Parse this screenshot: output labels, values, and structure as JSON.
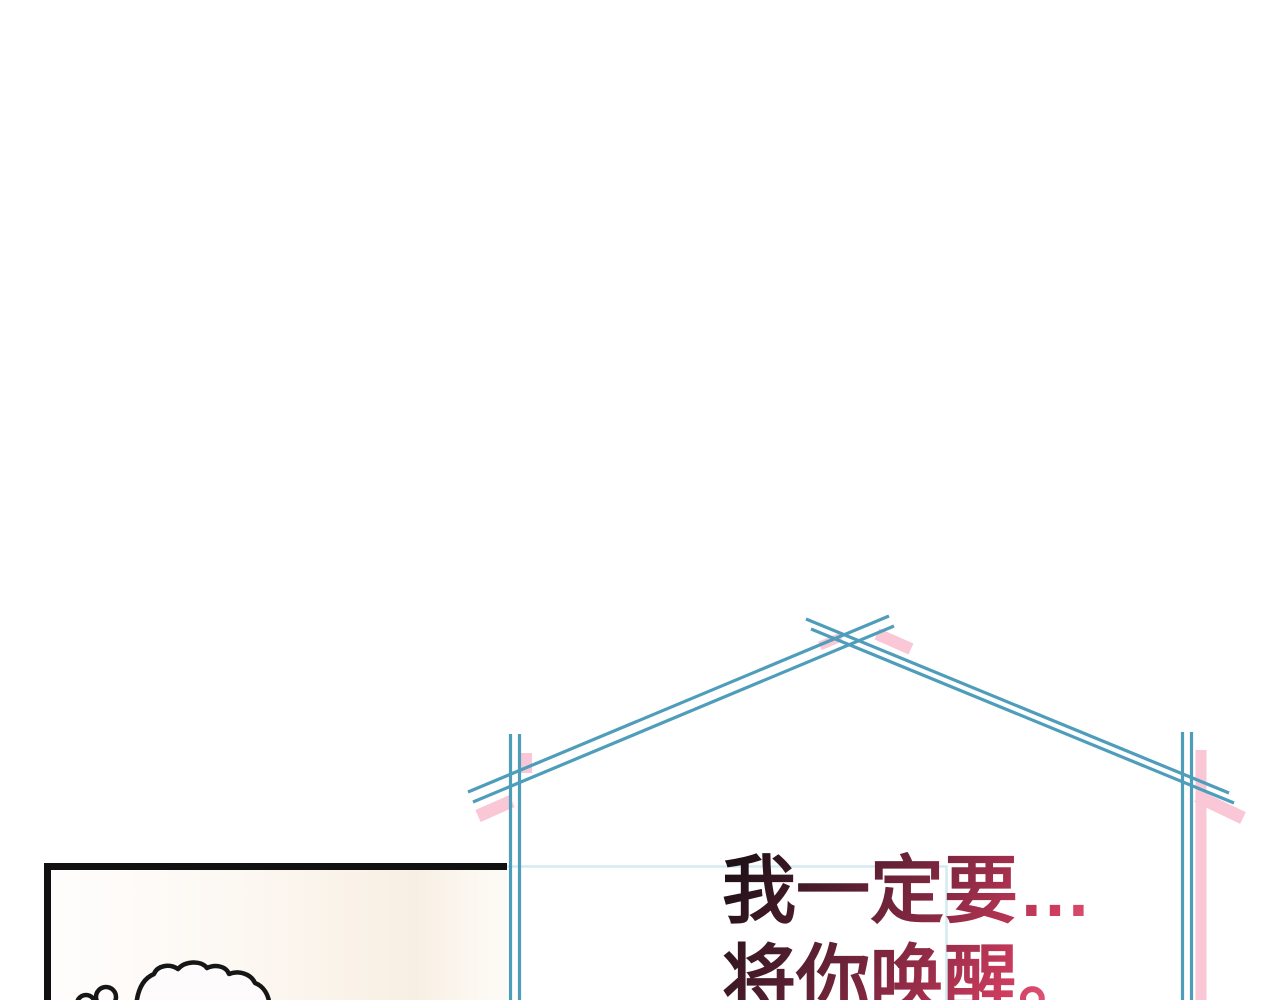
{
  "caption": {
    "line1": "我一定要…",
    "line2": "将你唤醒。"
  },
  "colors": {
    "page-bg": "#ffffff",
    "frame-blue": "#4e9dba",
    "accent-pink": "#f9c7d6",
    "faint-teal": "#d3ecf1",
    "panel-border": "#111111",
    "panel-bg-warm": "#f8efe3",
    "cloud-outline": "#161616",
    "caption-grad-1": "#1d1016",
    "caption-grad-2": "#4f1d2e",
    "caption-grad-3": "#8e2a45",
    "caption-grad-4": "#cf3c5e",
    "caption-grad-5": "#ef7598"
  }
}
